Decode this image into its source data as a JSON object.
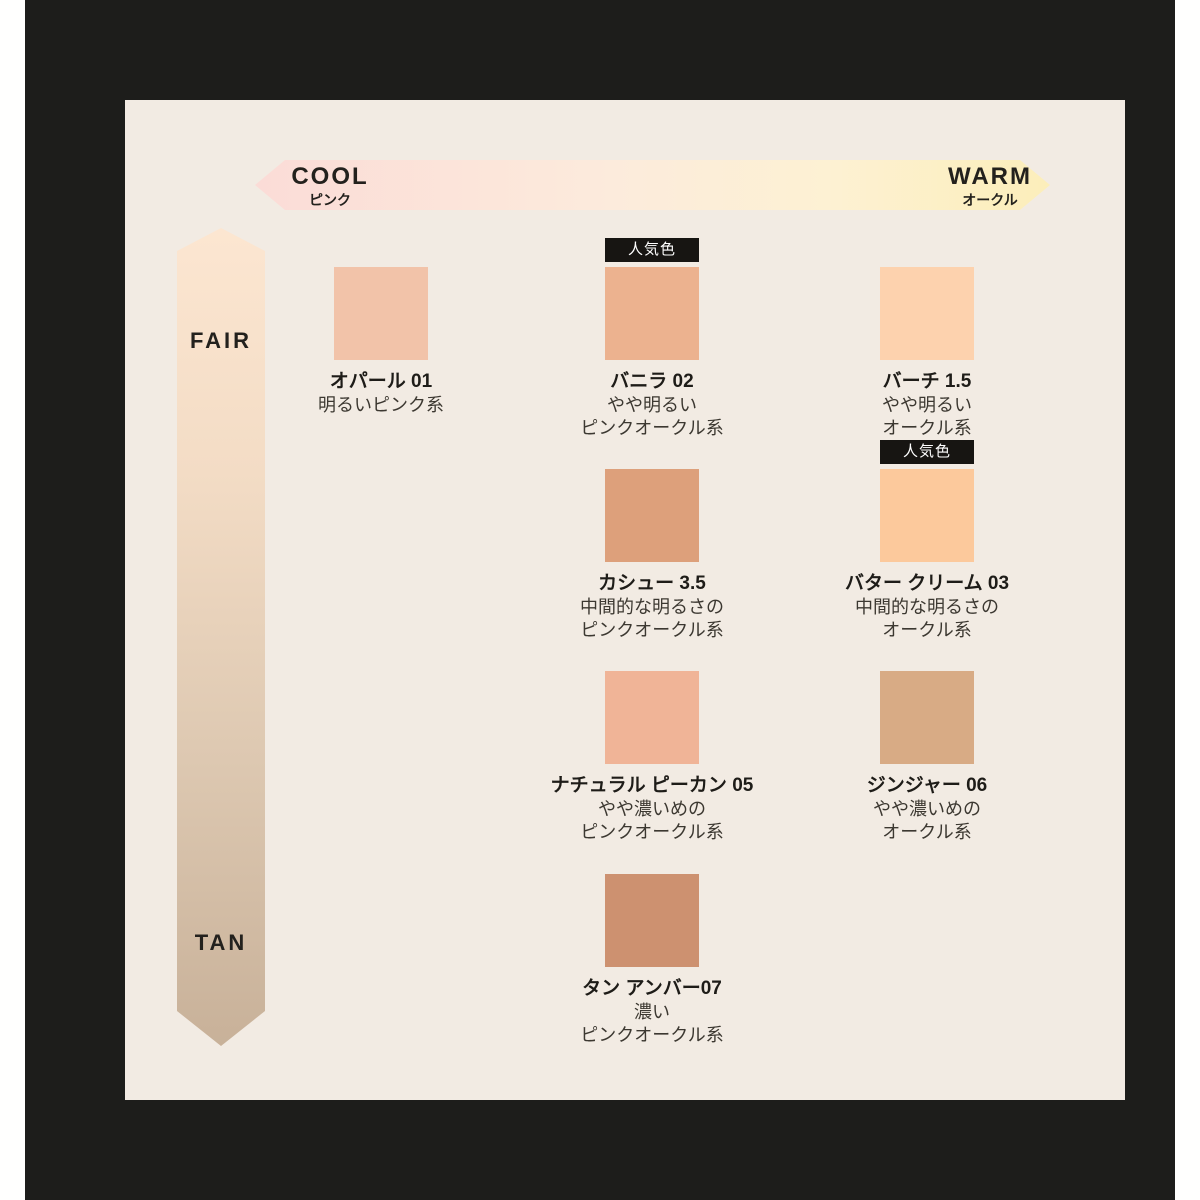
{
  "colors": {
    "page_margin": "#fffffe",
    "frame": "#1d1d1b",
    "panel": "#f2ebe3",
    "badge_bg": "#171512",
    "badge_text": "#ffffff"
  },
  "badge_label": "人気色",
  "axes": {
    "horizontal": {
      "left_label": "COOL",
      "left_sublabel": "ピンク",
      "right_label": "WARM",
      "right_sublabel": "オークル",
      "gradient": [
        "#fbdcd7",
        "#fcebdc",
        "#fdf1d3",
        "#fceeba"
      ],
      "gradient_stops": [
        0,
        45,
        72,
        100
      ]
    },
    "vertical": {
      "top_label": "FAIR",
      "bottom_label": "TAN",
      "gradient": [
        "#fce6d1",
        "#f3dcc5",
        "#ddc8b1",
        "#c8b199"
      ],
      "gradient_stops": [
        0,
        30,
        65,
        100
      ]
    }
  },
  "shades": [
    {
      "name": "オパール 01",
      "desc": [
        "明るいピンク系"
      ],
      "color": "#f2c3a9",
      "popular": false,
      "col": 1,
      "row": 1
    },
    {
      "name": "バニラ 02",
      "desc": [
        "やや明るい",
        "ピンクオークル系"
      ],
      "color": "#ecb28f",
      "popular": true,
      "col": 2,
      "row": 1
    },
    {
      "name": "バーチ 1.5",
      "desc": [
        "やや明るい",
        "オークル系"
      ],
      "color": "#fdd2ae",
      "popular": false,
      "col": 3,
      "row": 1
    },
    {
      "name": "カシュー 3.5",
      "desc": [
        "中間的な明るさの",
        "ピンクオークル系"
      ],
      "color": "#dda07b",
      "popular": false,
      "col": 2,
      "row": 2
    },
    {
      "name": "バター クリーム 03",
      "desc": [
        "中間的な明るさの",
        "オークル系"
      ],
      "color": "#fcc99c",
      "popular": true,
      "col": 3,
      "row": 2
    },
    {
      "name": "ナチュラル ピーカン 05",
      "desc": [
        "やや濃いめの",
        "ピンクオークル系"
      ],
      "color": "#f0b497",
      "popular": false,
      "col": 2,
      "row": 3
    },
    {
      "name": "ジンジャー 06",
      "desc": [
        "やや濃いめの",
        "オークル系"
      ],
      "color": "#d8ab85",
      "popular": false,
      "col": 3,
      "row": 3
    },
    {
      "name": "タン アンバー07",
      "desc": [
        "濃い",
        "ピンクオークル系"
      ],
      "color": "#cd9170",
      "popular": false,
      "col": 2,
      "row": 4
    }
  ],
  "chart_data": {
    "type": "table",
    "title": "",
    "x_axis": {
      "label_left": "COOL",
      "sub_left": "ピンク",
      "label_right": "WARM",
      "sub_right": "オークル"
    },
    "y_axis": {
      "label_top": "FAIR",
      "label_bottom": "TAN"
    },
    "legend": {
      "popular_badge": "人気色"
    },
    "points": [
      {
        "name": "オパール 01",
        "description": "明るいピンク系",
        "tone_col_cool_to_warm": 1,
        "depth_row_fair_to_tan": 1,
        "swatch_hex": "#f2c3a9",
        "popular": false
      },
      {
        "name": "バニラ 02",
        "description": "やや明るい ピンクオークル系",
        "tone_col_cool_to_warm": 2,
        "depth_row_fair_to_tan": 1,
        "swatch_hex": "#ecb28f",
        "popular": true
      },
      {
        "name": "バーチ 1.5",
        "description": "やや明るい オークル系",
        "tone_col_cool_to_warm": 3,
        "depth_row_fair_to_tan": 1,
        "swatch_hex": "#fdd2ae",
        "popular": false
      },
      {
        "name": "カシュー 3.5",
        "description": "中間的な明るさの ピンクオークル系",
        "tone_col_cool_to_warm": 2,
        "depth_row_fair_to_tan": 2,
        "swatch_hex": "#dda07b",
        "popular": false
      },
      {
        "name": "バター クリーム 03",
        "description": "中間的な明るさの オークル系",
        "tone_col_cool_to_warm": 3,
        "depth_row_fair_to_tan": 2,
        "swatch_hex": "#fcc99c",
        "popular": true
      },
      {
        "name": "ナチュラル ピーカン 05",
        "description": "やや濃いめの ピンクオークル系",
        "tone_col_cool_to_warm": 2,
        "depth_row_fair_to_tan": 3,
        "swatch_hex": "#f0b497",
        "popular": false
      },
      {
        "name": "ジンジャー 06",
        "description": "やや濃いめの オークル系",
        "tone_col_cool_to_warm": 3,
        "depth_row_fair_to_tan": 3,
        "swatch_hex": "#d8ab85",
        "popular": false
      },
      {
        "name": "タン アンバー07",
        "description": "濃い ピンクオークル系",
        "tone_col_cool_to_warm": 2,
        "depth_row_fair_to_tan": 4,
        "swatch_hex": "#cd9170",
        "popular": false
      }
    ]
  }
}
